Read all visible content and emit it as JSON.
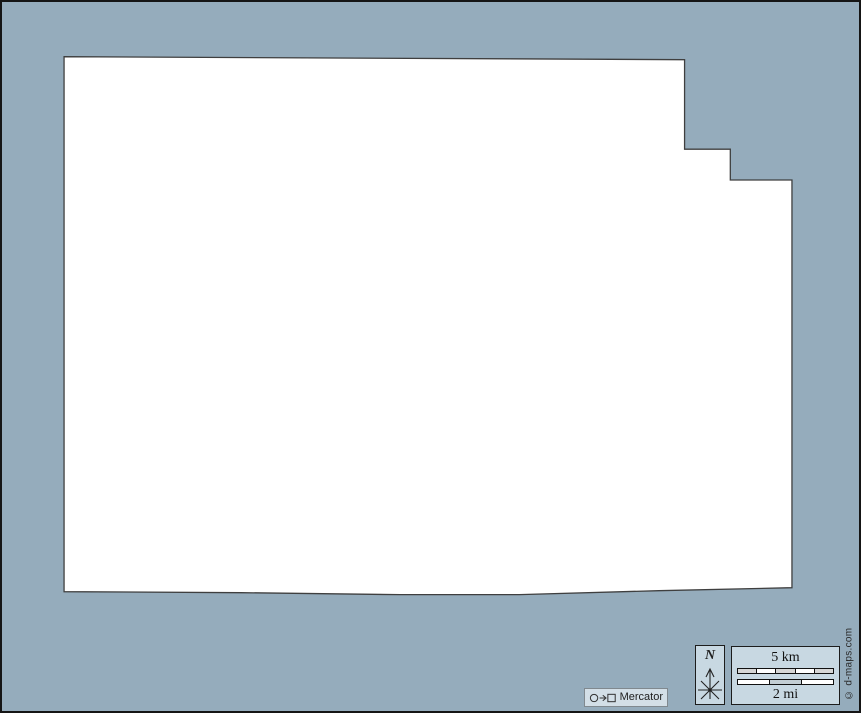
{
  "page": {
    "width": 861,
    "height": 713,
    "background_color": "#95acbc",
    "border_color": "#151515"
  },
  "map": {
    "fill": "#ffffff",
    "stroke": "#3f3f3f",
    "outline_points": [
      [
        62,
        55
      ],
      [
        686,
        58
      ],
      [
        686,
        148
      ],
      [
        732,
        148
      ],
      [
        732,
        179
      ],
      [
        794,
        179
      ],
      [
        794,
        589
      ],
      [
        660,
        592
      ],
      [
        520,
        596
      ],
      [
        400,
        596
      ],
      [
        240,
        594
      ],
      [
        62,
        593
      ]
    ]
  },
  "projection_badge": {
    "label": "Mercator",
    "icon": "circle-arrow-square"
  },
  "compass": {
    "north_label": "N"
  },
  "scale_box": {
    "km_label": "5 km",
    "mi_label": "2 mi",
    "box_background": "#c8d8e2",
    "km_bar_colors": [
      "#d6d6d6",
      "#ffffff",
      "#d6d6d6",
      "#ffffff",
      "#d6d6d6"
    ],
    "mi_bar_colors": [
      "#ffffff",
      "#c3ced4",
      "#ffffff"
    ]
  },
  "credit": {
    "text": "© d-maps.com"
  }
}
